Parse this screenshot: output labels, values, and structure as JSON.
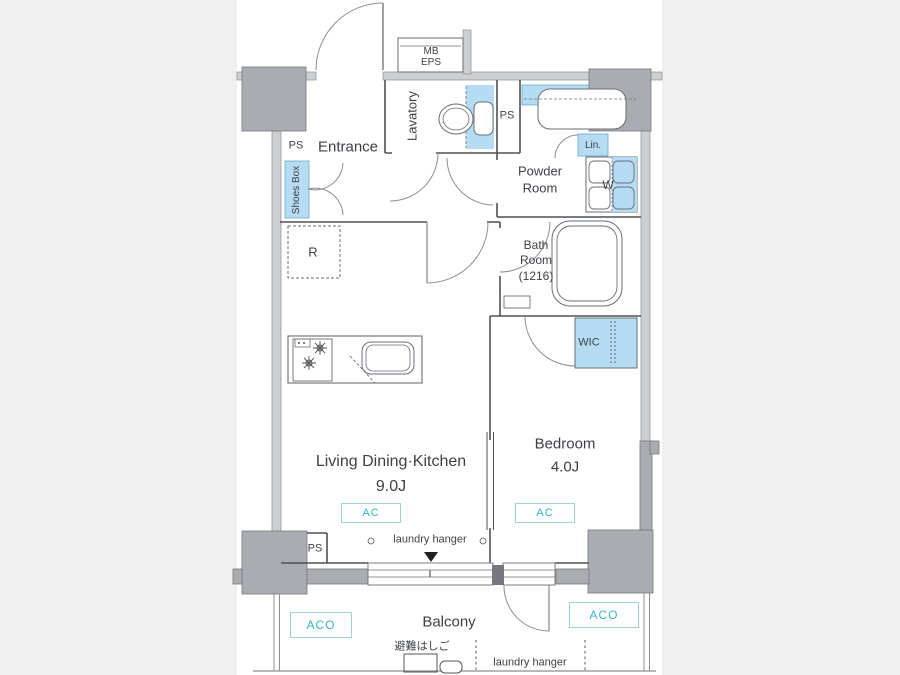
{
  "floor_plan": {
    "rooms": {
      "entrance": "Entrance",
      "lavatory": "Lavatory",
      "powder_room_line1": "Powder",
      "powder_room_line2": "Room",
      "bath_room_line1": "Bath",
      "bath_room_line2": "Room",
      "bath_room_line3": "(1216)",
      "ldk_name": "Living Dining·Kitchen",
      "ldk_size": "9.0J",
      "bedroom_name": "Bedroom",
      "bedroom_size": "4.0J",
      "balcony": "Balcony",
      "wic": "WIC"
    },
    "labels": {
      "mb": "MB",
      "eps": "EPS",
      "ps_entrance": "PS",
      "ps_lavatory": "PS",
      "ps_balcony": "PS",
      "shoes_box": "Shoes Box",
      "refrigerator": "R",
      "linen": "Lin.",
      "washer": "W",
      "ac_ldk": "AC",
      "ac_bedroom": "AC",
      "aco_left": "ACO",
      "aco_right": "ACO",
      "laundry_hanger_ldk": "laundry hanger",
      "laundry_hanger_balcony": "laundry hanger",
      "evacuation_ladder": "避難はしご"
    },
    "colors": {
      "fixture_highlight": "#b5dcf2",
      "accent_teal": "#35b5c9",
      "column_gray": "#a9acb0",
      "wall_gray": "#cdd0d3",
      "line": "#4d5156",
      "background": "#efefef"
    }
  }
}
